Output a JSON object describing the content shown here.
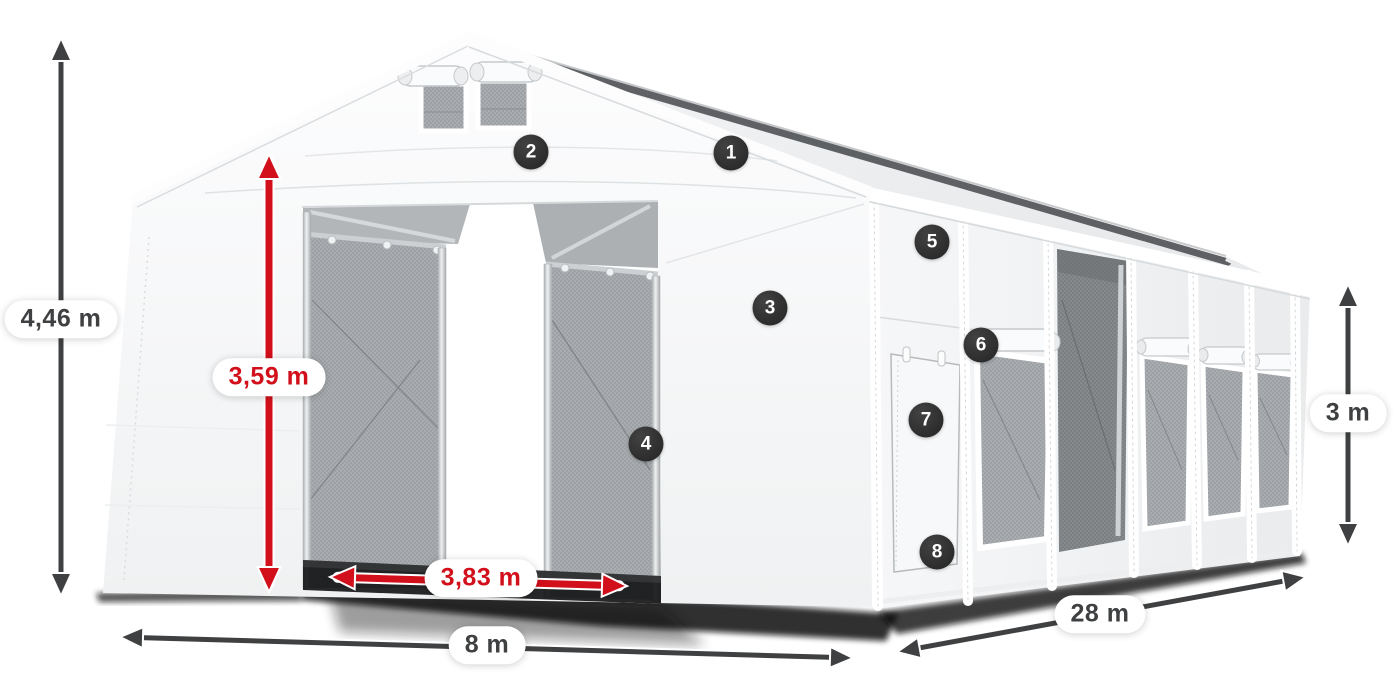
{
  "illustration": {
    "subject": "storage-tent",
    "colors": {
      "dimension_dark": "#3f4041",
      "dimension_red": "#d2101b",
      "badge_background": "#2b2b2b",
      "badge_text": "#ffffff",
      "label_background": "#ffffff"
    }
  },
  "dimensions": {
    "total_height": {
      "label": "4,46 m",
      "style": "dark"
    },
    "door_height": {
      "label": "3,59 m",
      "style": "red"
    },
    "door_width": {
      "label": "3,83 m",
      "style": "red"
    },
    "front_width": {
      "label": "8 m",
      "style": "dark"
    },
    "side_length": {
      "label": "28 m",
      "style": "dark"
    },
    "side_height": {
      "label": "3 m",
      "style": "dark"
    }
  },
  "markers": [
    "1",
    "2",
    "3",
    "4",
    "5",
    "6",
    "7",
    "8"
  ]
}
